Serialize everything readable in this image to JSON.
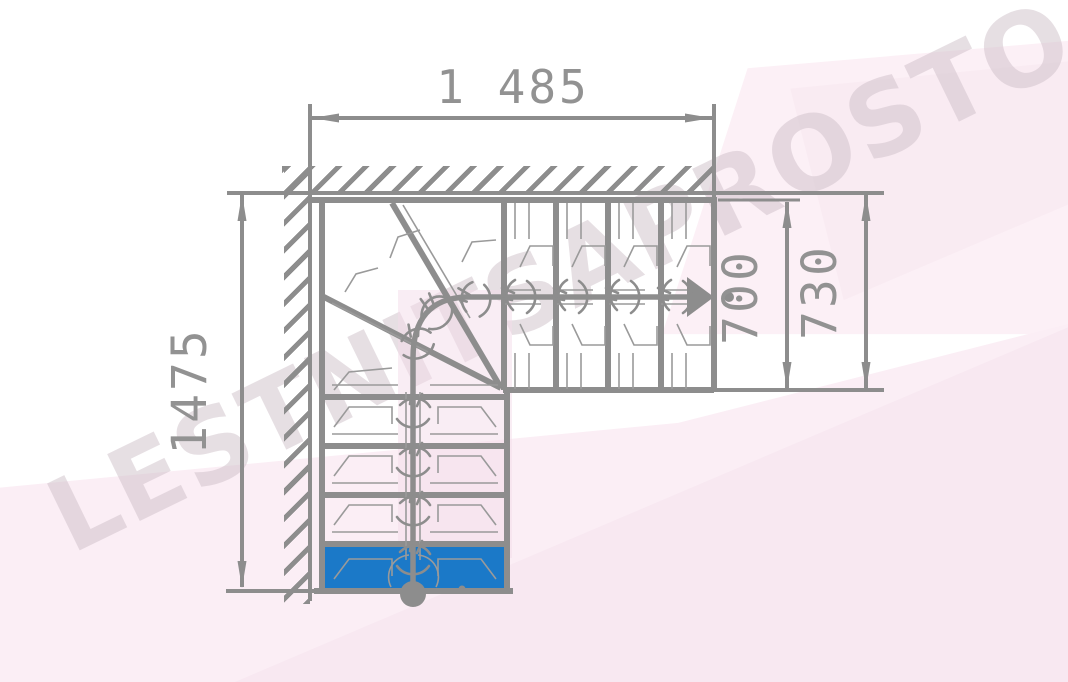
{
  "drawing": {
    "dimensions": {
      "width_top": "1 485",
      "height_left": "1475",
      "flight_width_inner": "700",
      "flight_width_outer": "730"
    },
    "watermark": "LESTNITSAPROSTO.RU",
    "colors": {
      "line_gray": "#8d8d8d",
      "text_gray": "#929292",
      "first_step_blue": "#1b79c8",
      "background_pink": "#fbeef5",
      "background_pink_dark": "#f7e6f0",
      "watermark_color": "#cfc0c9"
    }
  }
}
